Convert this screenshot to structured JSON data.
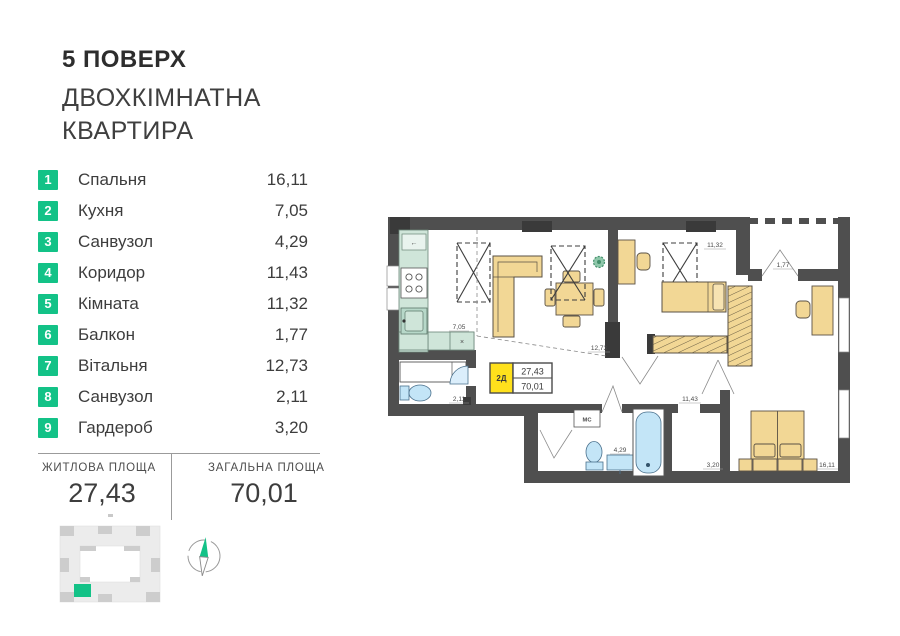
{
  "header": {
    "floor_title": "5 ПОВЕРХ",
    "subtitle_line1": "ДВОХКІМНАТНА",
    "subtitle_line2": "КВАРТИРА"
  },
  "rooms": [
    {
      "num": "1",
      "name": "Спальня",
      "area": "16,11"
    },
    {
      "num": "2",
      "name": "Кухня",
      "area": "7,05"
    },
    {
      "num": "3",
      "name": "Санвузол",
      "area": "4,29"
    },
    {
      "num": "4",
      "name": "Коридор",
      "area": "11,43"
    },
    {
      "num": "5",
      "name": "Кімната",
      "area": "11,32"
    },
    {
      "num": "6",
      "name": "Балкон",
      "area": "1,77"
    },
    {
      "num": "7",
      "name": "Вітальня",
      "area": "12,73"
    },
    {
      "num": "8",
      "name": "Санвузол",
      "area": "2,11"
    },
    {
      "num": "9",
      "name": "Гардероб",
      "area": "3,20"
    }
  ],
  "summary": {
    "living_label": "ЖИТЛОВА ПЛОЩА",
    "living_value": "27,43",
    "total_label": "ЗАГАЛЬНА ПЛОЩА",
    "total_value": "70,01"
  },
  "plan": {
    "unit_badge": {
      "type": "2Д",
      "living": "27,43",
      "total": "70,01"
    },
    "dims": {
      "kitchen": "7,05",
      "wc": "2,11",
      "living": "12,73",
      "room": "11,32",
      "balcony": "1,77",
      "corridor": "11,43",
      "bathroom": "4,29",
      "wardrobe": "3,20",
      "bedroom": "16,11"
    },
    "mc_label": "МС",
    "kitchen_x": "×",
    "hood_arrow": "←"
  },
  "colors": {
    "accent_green": "#13c287",
    "badge_yellow": "#ffe11c",
    "furniture_yellow": "#f2d795",
    "kitchen_mint": "#cfe5d9",
    "fixture_blue": "#c3e5f7",
    "wall_gray": "#4f4f4f"
  },
  "icons": [
    "compass-icon",
    "building-locator-icon",
    "plant-icon",
    "stove-icon",
    "sink-icon",
    "toilet-icon",
    "bathtub-icon"
  ]
}
